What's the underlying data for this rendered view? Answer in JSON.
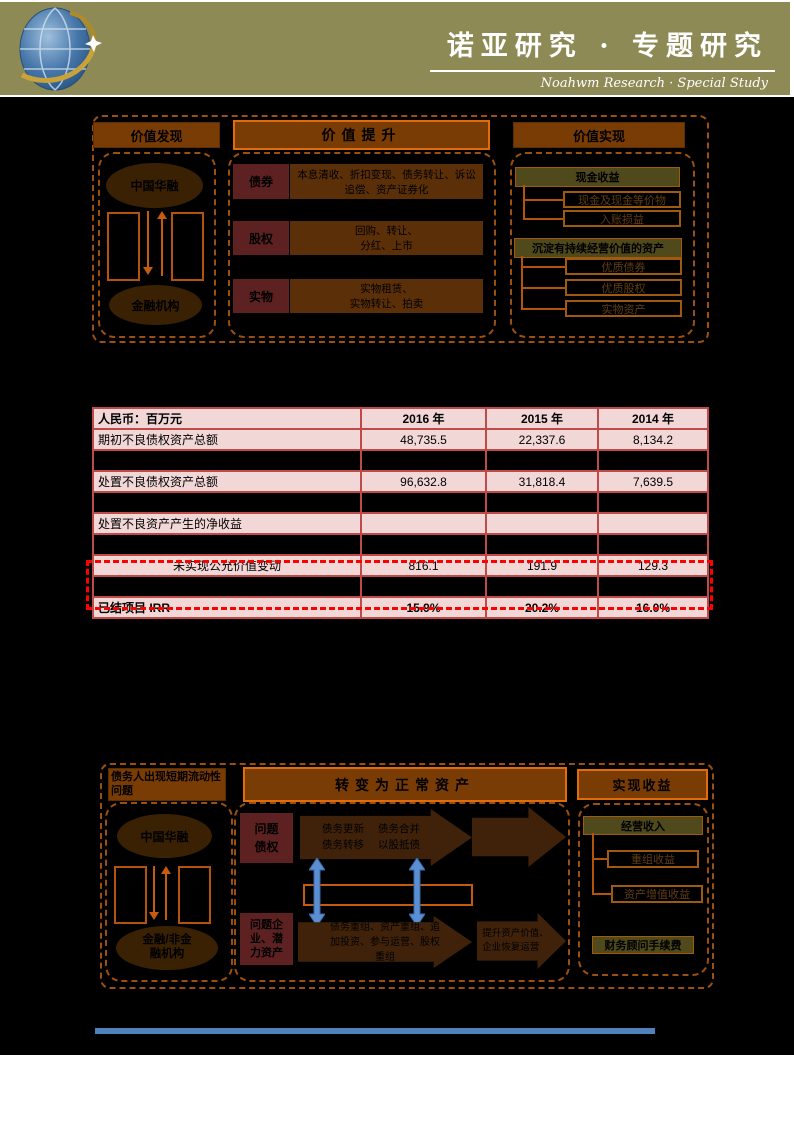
{
  "header": {
    "title": "诺亚研究 · 专题研究",
    "subtitle": "Noahwm Research · Special Study",
    "band_color": "#8e8a56"
  },
  "diagram1": {
    "col1_header": "价值发现",
    "col2_header": "价值提升",
    "col3_header": "价值实现",
    "left_top": "中国华融",
    "left_bottom": "金融机构",
    "rows": [
      {
        "label": "债券",
        "text": "本息清收、折扣变现、债务转让、诉讼追偿、资产证券化"
      },
      {
        "label": "股权",
        "text": "回购、转让、\n分红、上市"
      },
      {
        "label": "实物",
        "text": "实物租赁、\n实物转让、拍卖"
      }
    ],
    "cash_header": "现金收益",
    "cash_items": [
      "现金及现金等价物",
      "入账损益"
    ],
    "asset_header": "沉淀有持续经营价值的资产",
    "asset_items": [
      "优质债券",
      "优质股权",
      "实物资产"
    ]
  },
  "table": {
    "columns": [
      "人民币：百万元",
      "2016 年",
      "2015 年",
      "2014 年"
    ],
    "rows": [
      {
        "label": "期初不良债权资产总额",
        "v1": "48,735.5",
        "v2": "22,337.6",
        "v3": "8,134.2"
      },
      {
        "label": "处置不良债权资产总额",
        "v1": "96,632.8",
        "v2": "31,818.4",
        "v3": "7,639.5"
      },
      {
        "label": "处置不良资产产生的净收益",
        "v1": "",
        "v2": "",
        "v3": ""
      },
      {
        "label": "未实现公允价值变动",
        "v1": "816.1",
        "v2": "191.9",
        "v3": "129.3"
      },
      {
        "label": "已结项目 IRR",
        "v1": "15.9%",
        "v2": "20.2%",
        "v3": "16.0%"
      }
    ]
  },
  "diagram2": {
    "col1_header": "债务人出现短期流动性问题",
    "col2_header": "转变为正常资产",
    "col3_header": "实现收益",
    "left_top": "中国华融",
    "left_bottom": "金融/非金\n融机构",
    "problem_debt": "问题\n债权",
    "arrow1a": "债务更新\n债务转移",
    "arrow1b": "债务合并\n以股抵债",
    "problem_asset": "问题企\n业、潜\n力资产",
    "arrow3": "债务重组、资产重组、追加投资、参与运营、股权重组",
    "arrow4": "提升资产价值、\n企业恢复运营",
    "income_header": "经营收入",
    "income_items": [
      "重组收益",
      "资产增值收益"
    ],
    "fee": "财务顾问手续费"
  },
  "colors": {
    "accent_orange": "#c55a11",
    "maroon": "#5d2121",
    "brown": "#5b2f08",
    "olive": "#4f491c",
    "table_pink": "#f2d7d7",
    "table_border": "#bf4a4a",
    "highlight_red": "#ff0000",
    "divider_blue": "#4f81bd"
  }
}
